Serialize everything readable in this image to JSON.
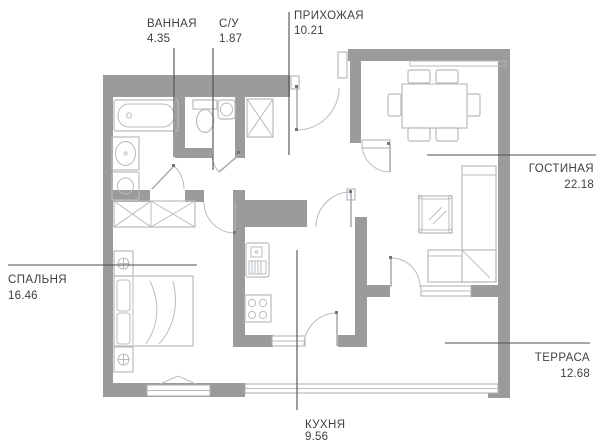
{
  "title": "apartment-floor-plan",
  "colors": {
    "wall": "#9b9b9b",
    "furniture": "#b7bcc0",
    "jamb": "#a9aeb3",
    "text": "#3f3f3f",
    "leader": "#4d4d4d",
    "bg": "#ffffff",
    "pin": "#757575"
  },
  "rooms": [
    {
      "key": "bathroom",
      "name": "ВАННАЯ",
      "area": "4.35"
    },
    {
      "key": "wc",
      "name": "С/У",
      "area": "1.87"
    },
    {
      "key": "hallway",
      "name": "ПРИХОЖАЯ",
      "area": "10.21"
    },
    {
      "key": "living",
      "name": "ГОСТИНАЯ",
      "area": "22.18"
    },
    {
      "key": "bedroom",
      "name": "СПАЛЬНЯ",
      "area": "16.46"
    },
    {
      "key": "terrace",
      "name": "ТЕРРАСА",
      "area": "12.68"
    },
    {
      "key": "kitchen",
      "name": "КУХНЯ",
      "area": "9.56"
    }
  ]
}
